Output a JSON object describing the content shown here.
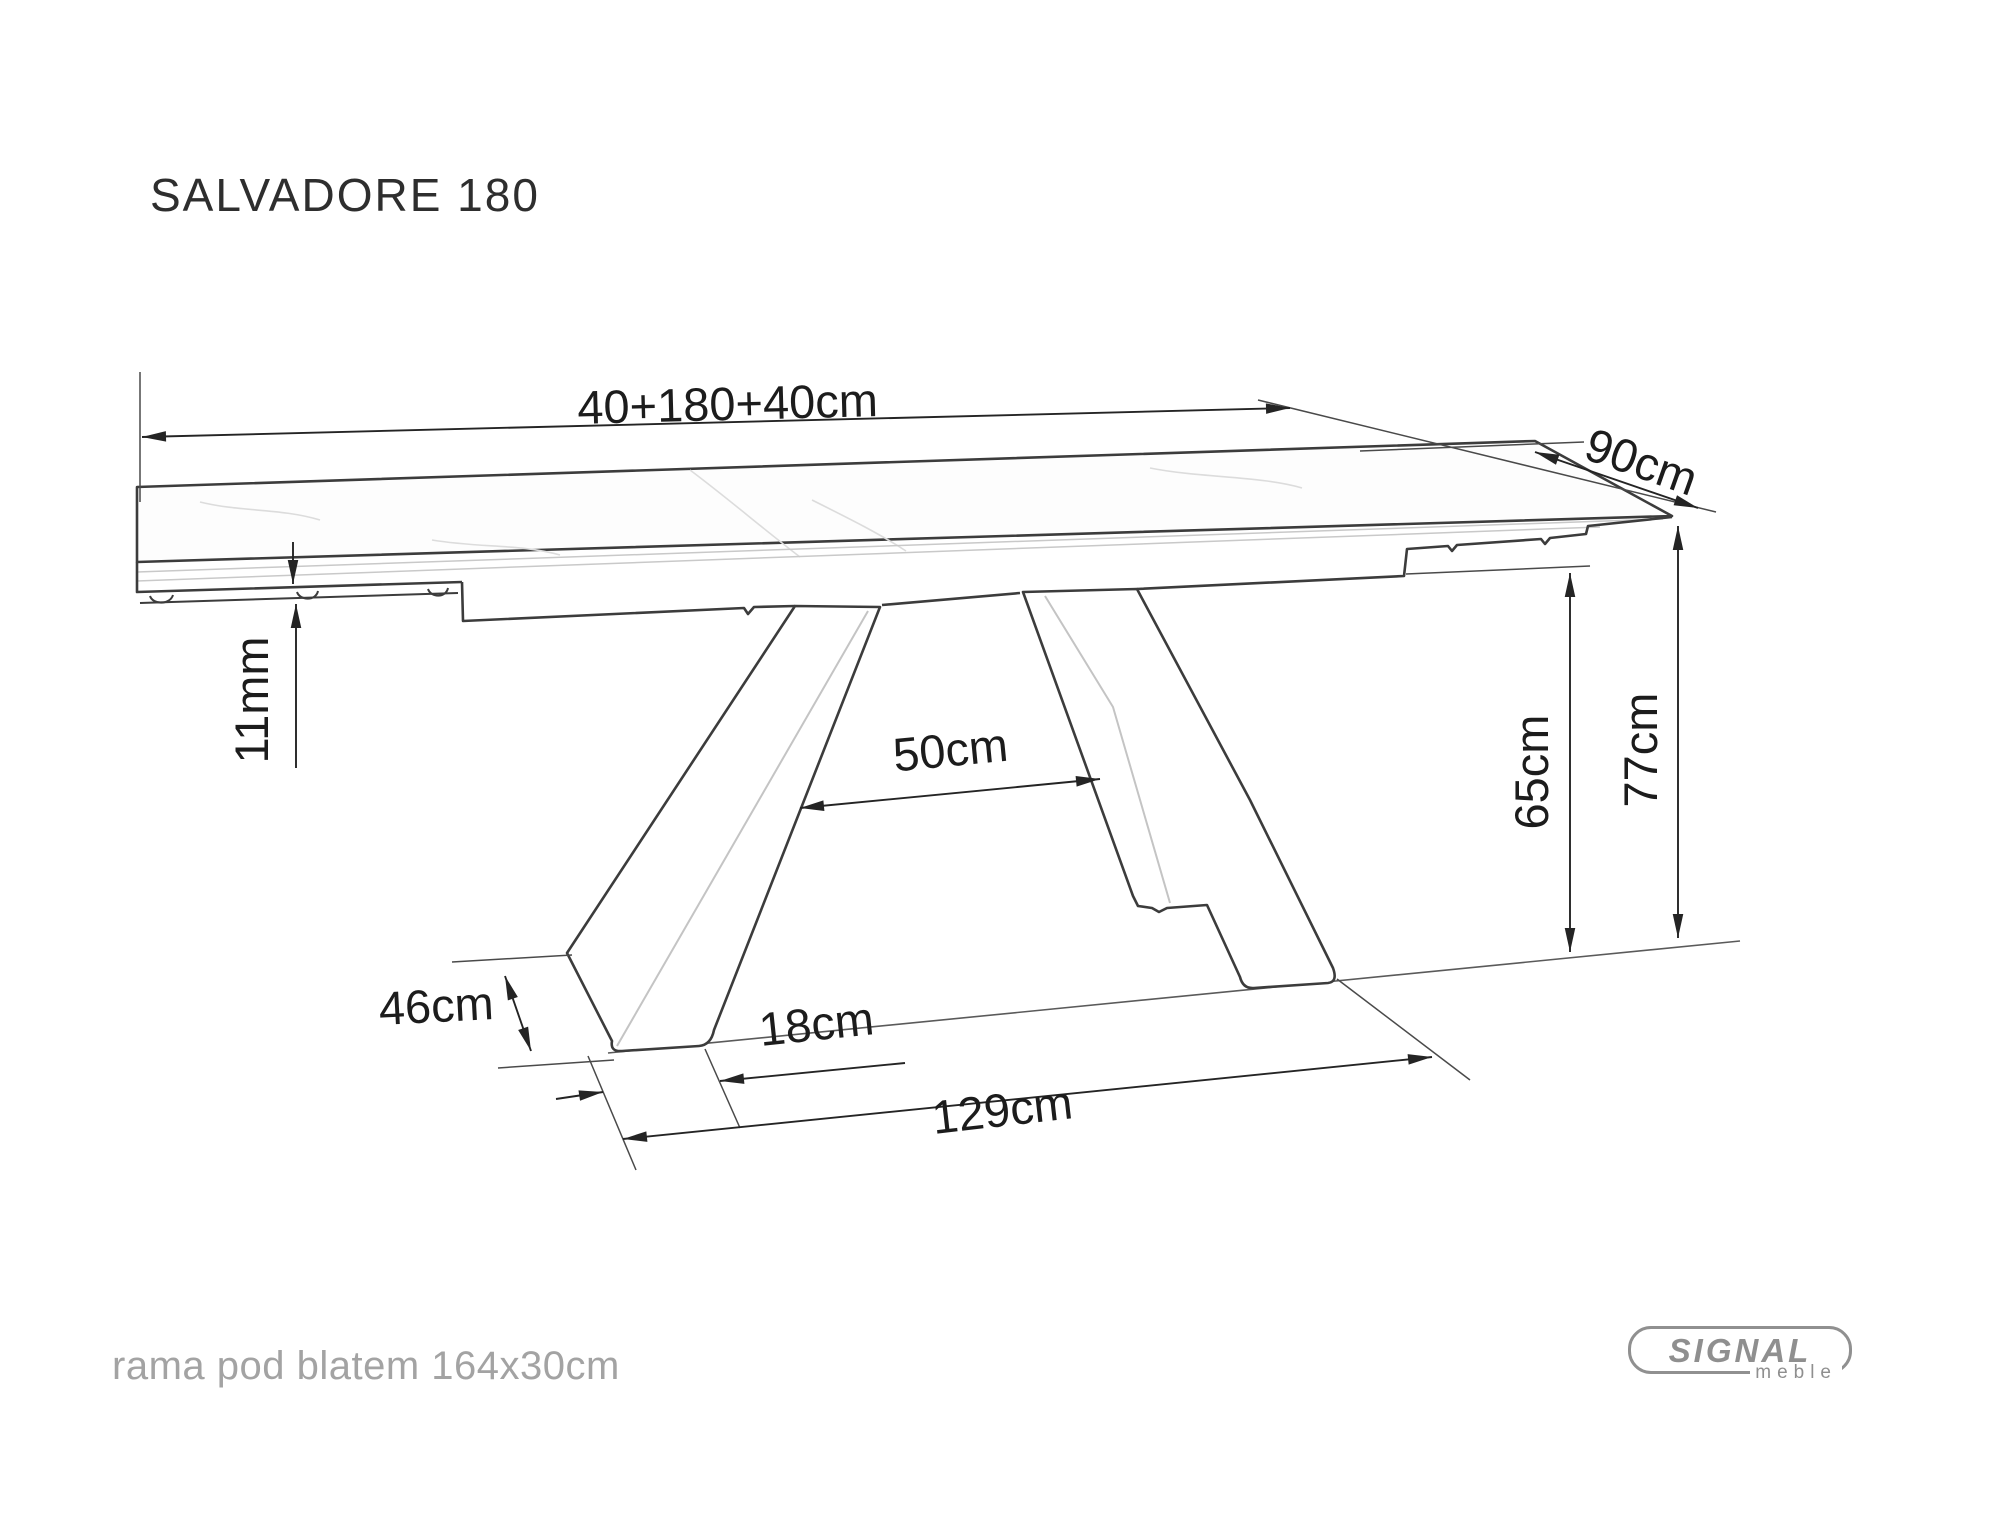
{
  "title": "SALVADORE 180",
  "footnote": "rama pod blatem 164x30cm",
  "logo": {
    "brand": "SIGNAL",
    "sub": "meble"
  },
  "diagram": {
    "description": "Side-view technical drawing of SALVADORE 180 extendable dining table with dimension callouts",
    "labels": {
      "length": "40+180+40cm",
      "depth": "90cm",
      "top_thickness": "11mm",
      "leg_top_gap": "50cm",
      "underframe_height": "65cm",
      "table_height": "77cm",
      "leg_slant": "46cm",
      "foot_depth": "18cm",
      "base_span": "129cm"
    },
    "colors": {
      "outline": "#3c3c3c",
      "dimension": "#242424",
      "crease": "#c4c4c4",
      "vein": "#dcdcdc",
      "note": "#a3a3a3",
      "logo": "#909090",
      "background": "#ffffff"
    }
  }
}
